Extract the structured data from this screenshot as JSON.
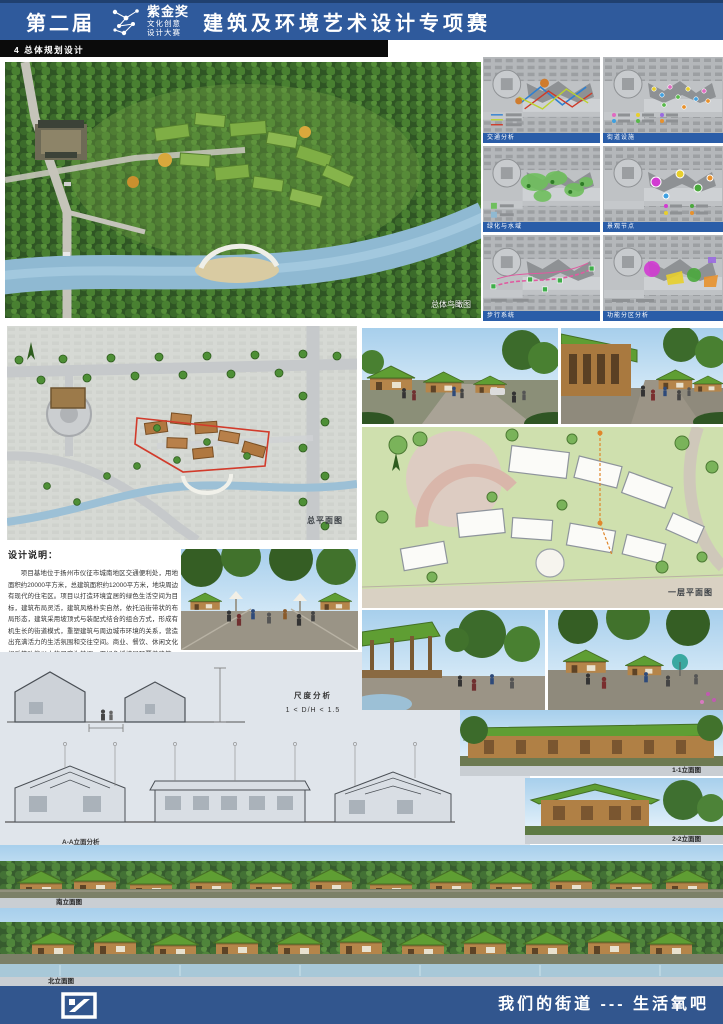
{
  "header": {
    "edition": "第二届",
    "award_name": "紫金奖",
    "award_line2": "文化创意",
    "award_line3": "设计大赛",
    "competition_title": "建筑及环境艺术设计专项赛"
  },
  "section_tab": "4 总体规划设计",
  "analysis_panels": [
    {
      "label": "交通分析"
    },
    {
      "label": "街道设施"
    },
    {
      "label": "绿化与水域"
    },
    {
      "label": "景观节点"
    },
    {
      "label": "步行系统"
    },
    {
      "label": "功能分区分析"
    }
  ],
  "captions": {
    "aerial": "总体鸟瞰图",
    "site_plan": "总平面图",
    "floor_plan": "一层平面图",
    "aa_elevation": "A-A立面分析",
    "elevation_11": "1-1立面图",
    "elevation_22": "2-2立面图",
    "south_elevation": "南立面图",
    "north_elevation": "北立面图"
  },
  "scale_analysis": {
    "title": "尺度分析",
    "formula": "1 < D/H < 1.5"
  },
  "design_notes": {
    "title": "设计说明：",
    "part1": "项目基地位于扬州市仪征市城南地区交通便利处，用地面积约20000平方米，总建筑面积约12000平方米，地块周边有现代的住宅区。项目以打造环境宜居的绿色生活空间为目标，建筑布局灵活，建筑风格朴实自然，依托沿街带状的布局形态，建筑采用坡顶式与装配式结合的组合方式，形成有机生长的街道模式，重塑建筑与周边城市环境的关系，营造出充满活力的生活氛围和交往空间。商业、餐饮、休闲文化娱乐等功能以人的尺度为基调，用绿色缓坡屋顶覆盖建筑，融入自然。主体业态以小木屋建筑群为主，沿街立面木质构件质朴温暖，建筑沿街形成连续的一幅",
    "highlight1": "“生活氧吧”",
    "part2": "式街区。小木屋顶覆盖绿化屋面，保持一致性态度。人们在此购物、养生、闲暇交往，慢节奏地享受户外大自然的调节与养生活状态，在这里体验",
    "highlight2": "“慢生活、养生活、享生活”",
    "part3": "的人生理念。"
  },
  "footer": {
    "slogan": "我们的街道 --- 生活氧吧"
  },
  "colors": {
    "header_blue": "#2f5a9c",
    "caption_blue": "#2a5da8",
    "footer_blue": "#32568e",
    "highlight_green": "#1f9d3c",
    "highlight_blue": "#2a6ad4",
    "roof_green": "#5f9e33",
    "wood_brown": "#b5854a"
  }
}
